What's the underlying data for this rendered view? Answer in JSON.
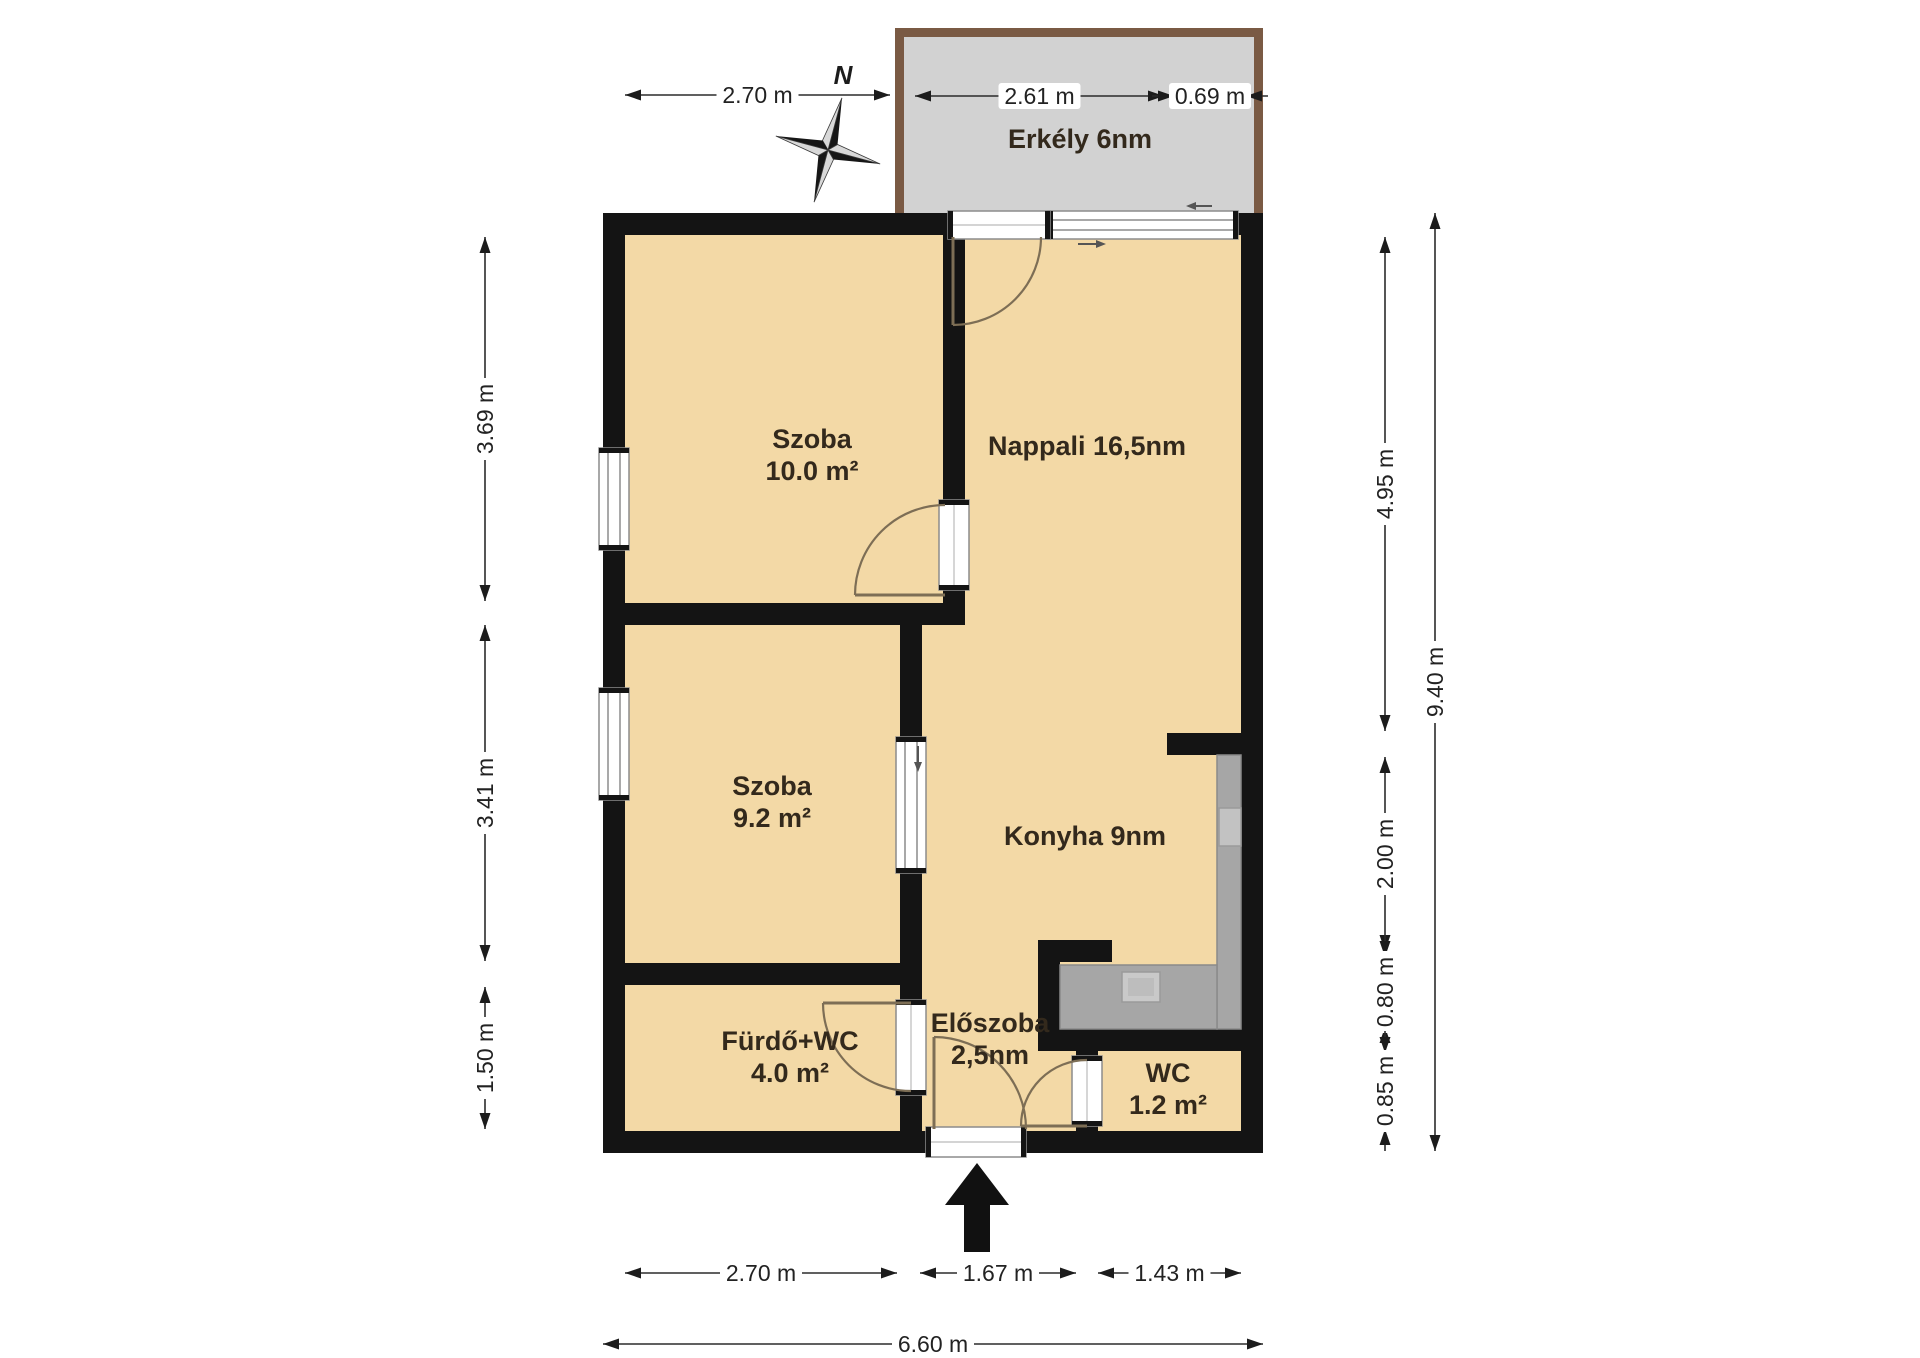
{
  "colors": {
    "background": "#ffffff",
    "wall": "#141414",
    "room_fill": "#f3d9a6",
    "balcony_fill": "#d2d2d2",
    "balcony_border": "#7a5a44",
    "counter_fill": "#a6a6a6",
    "counter_edge": "#8a8a8a",
    "sink_fill": "#c9c9c9",
    "window_frame": "#8c8c8c",
    "door_arc": "#7d6e55",
    "dim": "#222222",
    "label": "#33291c"
  },
  "rooms": [
    {
      "id": "szoba-1",
      "lines": [
        "Szoba",
        "10.0 m²"
      ],
      "cx": 812,
      "cy": 448
    },
    {
      "id": "szoba-2",
      "lines": [
        "Szoba",
        "9.2 m²"
      ],
      "cx": 772,
      "cy": 795
    },
    {
      "id": "furdo-wc",
      "lines": [
        "Fürdő+WC",
        "4.0 m²"
      ],
      "cx": 790,
      "cy": 1050
    },
    {
      "id": "nappali",
      "lines": [
        "Nappali 16,5nm"
      ],
      "cx": 1087,
      "cy": 455
    },
    {
      "id": "konyha",
      "lines": [
        "Konyha 9nm"
      ],
      "cx": 1085,
      "cy": 845
    },
    {
      "id": "eloszoba",
      "lines": [
        "Előszoba",
        "2,5nm"
      ],
      "cx": 990,
      "cy": 1032
    },
    {
      "id": "wc",
      "lines": [
        "WC",
        "1.2 m²"
      ],
      "cx": 1168,
      "cy": 1082
    },
    {
      "id": "erkely",
      "lines": [
        "Erkély 6nm"
      ],
      "cx": 1080,
      "cy": 148
    }
  ],
  "dimensions": [
    {
      "label": "2.70 m",
      "o": "h",
      "pos": 95,
      "from": 625,
      "to": 890
    },
    {
      "label": "2.61 m",
      "o": "h",
      "pos": 96,
      "from": 915,
      "to": 1164,
      "boxed": true
    },
    {
      "label": "0.69 m",
      "o": "h",
      "pos": 96,
      "from": 1174,
      "to": 1246,
      "boxed": true,
      "tips": "in"
    },
    {
      "label": "3.69 m",
      "o": "v",
      "pos": 485,
      "from": 237,
      "to": 601
    },
    {
      "label": "3.41 m",
      "o": "v",
      "pos": 485,
      "from": 625,
      "to": 961
    },
    {
      "label": "1.50 m",
      "o": "v",
      "pos": 485,
      "from": 987,
      "to": 1129
    },
    {
      "label": "4.95 m",
      "o": "v",
      "pos": 1385,
      "from": 237,
      "to": 731
    },
    {
      "label": "2.00 m",
      "o": "v",
      "pos": 1385,
      "from": 757,
      "to": 951
    },
    {
      "label": "0.80 m",
      "o": "v",
      "pos": 1385,
      "from": 957,
      "to": 1027,
      "tips": "in"
    },
    {
      "label": "0.85 m",
      "o": "v",
      "pos": 1385,
      "from": 1053,
      "to": 1129,
      "tips": "in"
    },
    {
      "label": "9.40 m",
      "o": "v",
      "pos": 1435,
      "from": 213,
      "to": 1151
    },
    {
      "label": "2.70 m",
      "o": "h",
      "pos": 1273,
      "from": 625,
      "to": 897
    },
    {
      "label": "1.67 m",
      "o": "h",
      "pos": 1273,
      "from": 920,
      "to": 1076
    },
    {
      "label": "1.43 m",
      "o": "h",
      "pos": 1273,
      "from": 1098,
      "to": 1241
    },
    {
      "label": "6.60 m",
      "o": "h",
      "pos": 1344,
      "from": 603,
      "to": 1263
    }
  ],
  "compass": {
    "label": "N",
    "cx": 828,
    "cy": 150,
    "R": 54,
    "r": 11,
    "rot": 15,
    "label_x": 843,
    "label_y": 84
  },
  "geometry": {
    "interior": [
      614,
      224,
      638,
      918
    ],
    "balcony_outer": [
      895,
      28,
      368,
      185
    ],
    "balcony_inner": [
      904,
      37,
      350,
      176
    ],
    "walls": [
      [
        603,
        213,
        660,
        22
      ],
      [
        603,
        1131,
        660,
        22
      ],
      [
        603,
        213,
        22,
        940
      ],
      [
        1241,
        213,
        22,
        940
      ],
      [
        625,
        603,
        340,
        22
      ],
      [
        943,
        235,
        22,
        368
      ],
      [
        900,
        603,
        22,
        528
      ],
      [
        625,
        963,
        297,
        22
      ],
      [
        1167,
        733,
        74,
        22
      ],
      [
        1038,
        940,
        22,
        111
      ],
      [
        1038,
        940,
        74,
        22
      ],
      [
        1038,
        1029,
        225,
        22
      ],
      [
        1076,
        1051,
        22,
        80
      ]
    ],
    "windows": [
      {
        "r": [
          599,
          448,
          30,
          102
        ],
        "dir": "v"
      },
      {
        "r": [
          599,
          688,
          30,
          112
        ],
        "dir": "v"
      },
      {
        "r": [
          1048,
          211,
          190,
          28
        ],
        "dir": "h"
      },
      {
        "r": [
          896,
          737,
          30,
          136
        ],
        "dir": "v"
      }
    ],
    "door_frames": [
      {
        "r": [
          939,
          500,
          30,
          90
        ],
        "dir": "v"
      },
      {
        "r": [
          896,
          1000,
          30,
          95
        ],
        "dir": "v"
      },
      {
        "r": [
          1072,
          1056,
          30,
          70
        ],
        "dir": "v"
      },
      {
        "r": [
          926,
          1127,
          100,
          30
        ],
        "dir": "h"
      },
      {
        "r": [
          948,
          211,
          102,
          28
        ],
        "dir": "h"
      }
    ],
    "doors": [
      {
        "hinge": [
          953,
          237
        ],
        "panel": [
          953,
          325
        ],
        "end": [
          1041,
          237
        ],
        "r": 88,
        "sweep": 0
      },
      {
        "hinge": [
          945,
          595
        ],
        "panel": [
          855,
          595
        ],
        "end": [
          945,
          505
        ],
        "r": 90,
        "sweep": 1
      },
      {
        "hinge": [
          911,
          1003
        ],
        "panel": [
          823,
          1003
        ],
        "end": [
          911,
          1091
        ],
        "r": 88,
        "sweep": 0
      },
      {
        "hinge": [
          1087,
          1126
        ],
        "panel": [
          1021,
          1126
        ],
        "end": [
          1087,
          1060
        ],
        "r": 66,
        "sweep": 1
      },
      {
        "hinge": [
          934,
          1129
        ],
        "panel": [
          934,
          1037
        ],
        "end": [
          1026,
          1129
        ],
        "r": 92,
        "sweep": 1
      }
    ],
    "counters": [
      [
        1217,
        755,
        24,
        274
      ],
      [
        1060,
        965,
        157,
        64
      ]
    ],
    "sink": [
      1122,
      972,
      38,
      30
    ],
    "stove": [
      1219,
      808,
      22,
      38
    ],
    "small_arrows": [
      {
        "from": [
          1078,
          244
        ],
        "to": [
          1106,
          244
        ]
      },
      {
        "from": [
          1212,
          206
        ],
        "to": [
          1186,
          206
        ]
      },
      {
        "from": [
          918,
          746
        ],
        "to": [
          918,
          772
        ]
      }
    ],
    "entrance_arrow": "977,1163 1009,1205 990,1205 990,1252 964,1252 964,1205 945,1205"
  }
}
